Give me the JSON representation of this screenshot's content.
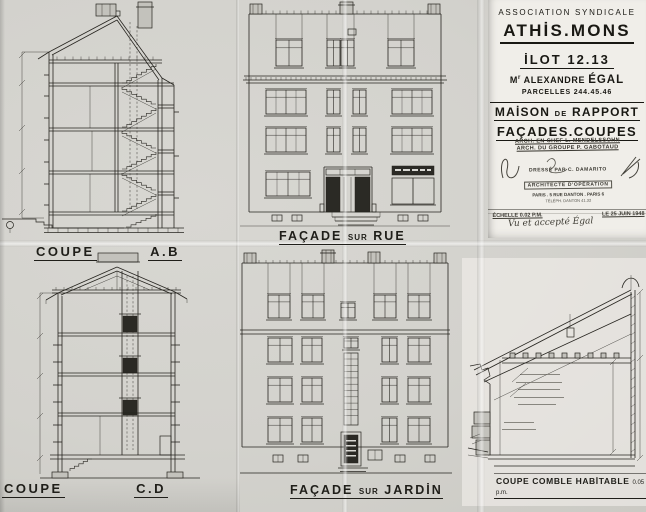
{
  "sheet": {
    "paper_color": "#d5d4cf",
    "ink_color": "#26241f",
    "title_paper_color": "#f0eee9"
  },
  "title_block": {
    "association": "ASSOCIATION SYNDICALE",
    "city": "ATHİS.MONS",
    "ilot": "İLOT 12.13",
    "owner_prefix": "M",
    "owner_sup": "r",
    "owner_name": "ALEXANDRE",
    "owner_surname": "ÉGAL",
    "parcelles": "PARCELLES 244.45.46",
    "maison_1": "MAİSON",
    "maison_2": "DE",
    "maison_3": "RAPPORT",
    "facades_coupes": "FAÇADES.COUPES"
  },
  "stamp": {
    "arch_line1": "ARCH. EN CHEF L. MENDELSSOHN",
    "arch_line2": "ARCH. DU GROUPE P. GABOTAUD",
    "dresse_line1": "DRESSÉ PAR C. DAMARITO",
    "dresse_line2": "ARCHITECTE D'OPÉRATION",
    "dresse_line3": "PARIS . 5 RUE DANTON . PARIS 6",
    "dresse_line4": "TÉLÉPH. DANTON 41.32",
    "echelle": "ÉCHELLE 0.02 P.M.",
    "date": "LE 25 JUIN 1948",
    "approval_note": "Vu et accepté Égal"
  },
  "labels": {
    "coupe_ab": {
      "word": "COUPE",
      "ref": "A.B"
    },
    "facade_rue": {
      "part1": "FAÇADE",
      "part2": "SUR",
      "part3": "RUE"
    },
    "coupe_cd": {
      "word": "COUPE",
      "ref": "C.D"
    },
    "facade_jardin": {
      "part1": "FAÇADE",
      "part2": "SUR",
      "part3": "JARDİN"
    },
    "coupe_comble": {
      "title": "COUPE COMBLE HABİTABLE",
      "scale": "0.05 p.m."
    }
  }
}
